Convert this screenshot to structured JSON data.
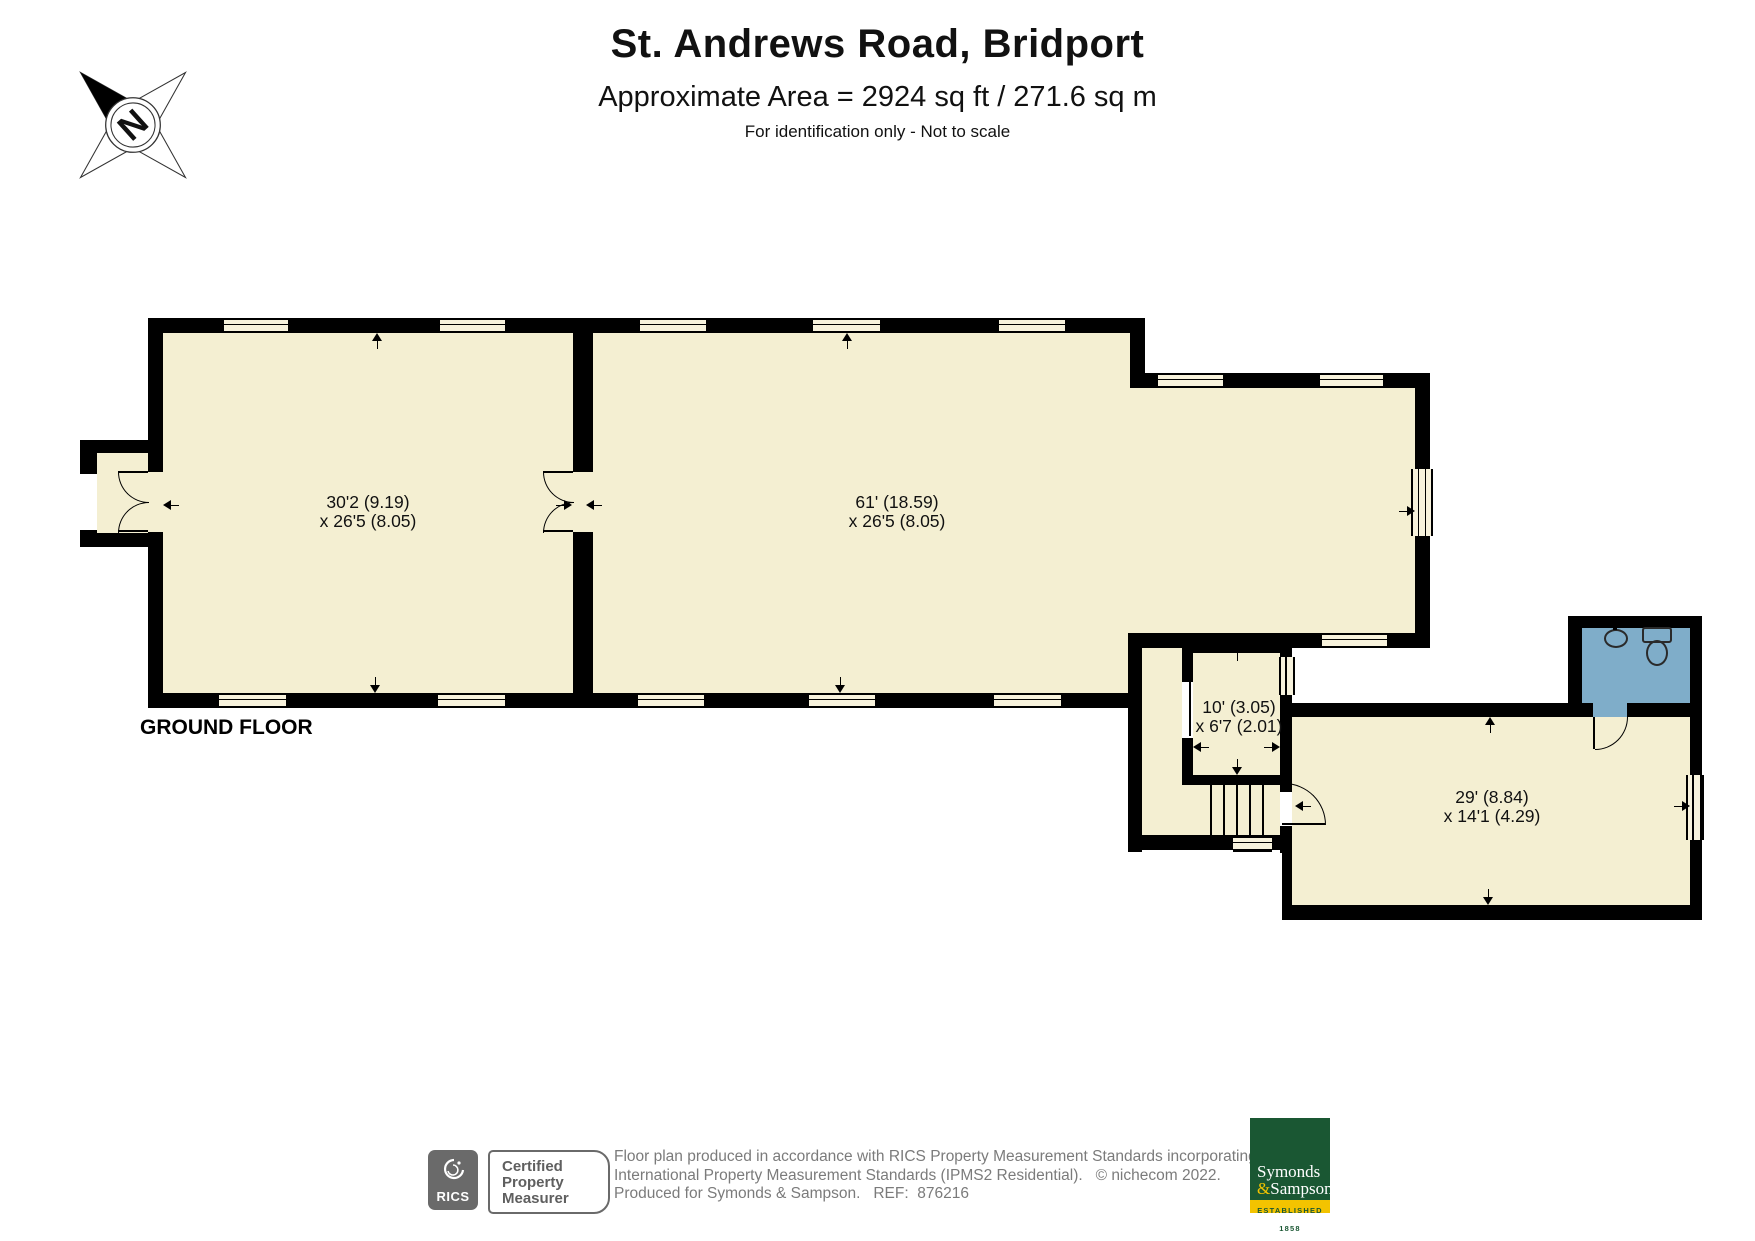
{
  "header": {
    "title": "St. Andrews Road, Bridport",
    "subtitle": "Approximate Area = 2924 sq ft / 271.6 sq m",
    "note": "For identification only - Not to scale"
  },
  "compass": {
    "label": "N"
  },
  "floor": {
    "label": "GROUND FLOOR",
    "rooms": [
      {
        "name": "room-left",
        "dim_line1": "30'2 (9.19)",
        "dim_line2": "x 26'5 (8.05)"
      },
      {
        "name": "room-main",
        "dim_line1": "61' (18.59)",
        "dim_line2": "x 26'5 (8.05)"
      },
      {
        "name": "lobby",
        "dim_line1": "10' (3.05)",
        "dim_line2": "x 6'7 (2.01)"
      },
      {
        "name": "annex",
        "dim_line1": "29' (8.84)",
        "dim_line2": "x 14'1 (4.29)"
      }
    ]
  },
  "footer": {
    "rics_label": "RICS",
    "certified_lines": [
      "Certified",
      "Property",
      "Measurer"
    ],
    "disclaimer_lines": [
      "Floor plan produced in accordance with RICS Property Measurement Standards incorporating",
      "International Property Measurement Standards (IPMS2 Residential).   © nichecom 2022.",
      "Produced for Symonds & Sampson.   REF:  876216"
    ],
    "agency": {
      "line1": "Symonds",
      "amp": "&",
      "line2": "Sampson",
      "established": "ESTABLISHED 1858"
    }
  },
  "colors": {
    "room_fill": "#F4EFD2",
    "bathroom_fill": "#7FADC9",
    "wall": "#000000",
    "agency_green": "#1A5733",
    "agency_gold": "#F3C300",
    "footer_gray": "#7b7b7b"
  }
}
